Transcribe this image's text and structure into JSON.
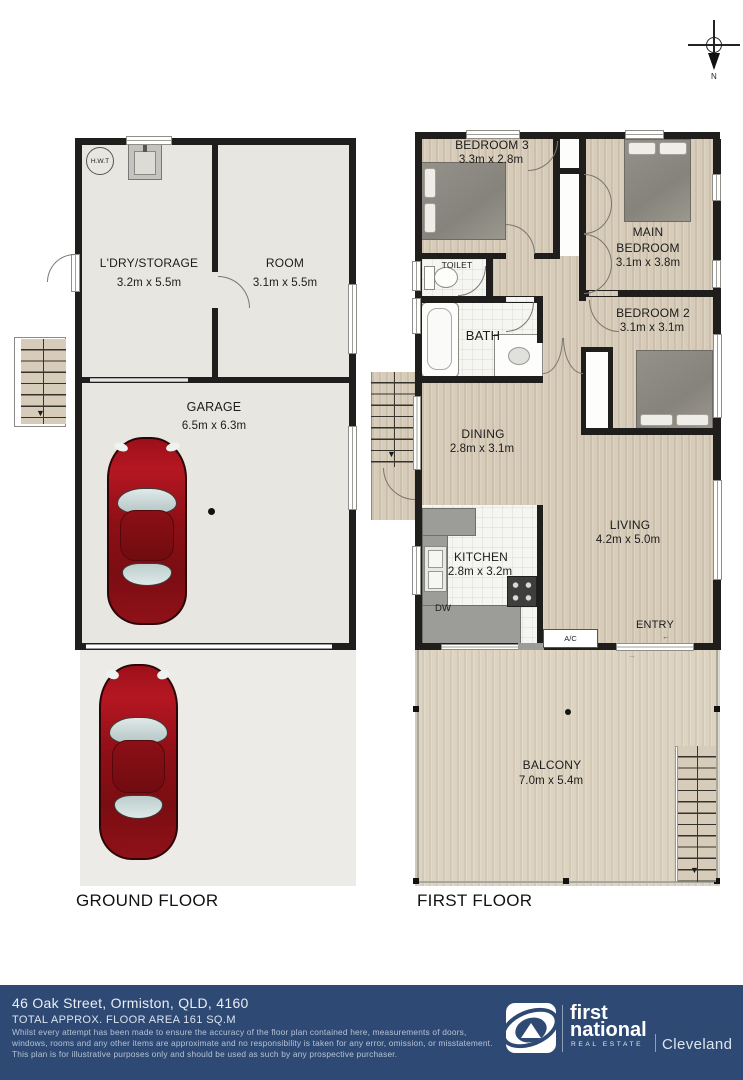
{
  "compass": {
    "north_label": "N"
  },
  "ground_floor": {
    "title": "GROUND FLOOR",
    "hwt_label": "H.W.T",
    "rooms": {
      "laundry": {
        "name": "L'DRY/STORAGE",
        "dims": "3.2m x 5.5m"
      },
      "room": {
        "name": "ROOM",
        "dims": "3.1m x 5.5m"
      },
      "garage": {
        "name": "GARAGE",
        "dims": "6.5m x 6.3m"
      }
    }
  },
  "first_floor": {
    "title": "FIRST FLOOR",
    "rooms": {
      "bedroom3": {
        "name": "BEDROOM 3",
        "dims": "3.3m x 2.8m"
      },
      "main_bedroom": {
        "name": "MAIN BEDROOM",
        "dims": "3.1m x 3.8m"
      },
      "bedroom2": {
        "name": "BEDROOM 2",
        "dims": "3.1m x 3.1m"
      },
      "toilet": {
        "name": "TOILET"
      },
      "bath": {
        "name": "BATH"
      },
      "dining": {
        "name": "DINING",
        "dims": "2.8m x 3.1m"
      },
      "kitchen": {
        "name": "KITCHEN",
        "dims": "2.8m x 3.2m"
      },
      "living": {
        "name": "LIVING",
        "dims": "4.2m x 5.0m"
      },
      "entry": {
        "name": "ENTRY"
      },
      "balcony": {
        "name": "BALCONY",
        "dims": "7.0m x 5.4m"
      }
    },
    "labels": {
      "dishwasher": "DW",
      "air_conditioner": "A/C"
    }
  },
  "icons": {
    "stairs_down_arrow": "▼",
    "entry_arrow_left": "←",
    "entry_arrow_right": "→"
  },
  "footer": {
    "address": "46 Oak Street, Ormiston, QLD, 4160",
    "floor_area": "TOTAL APPROX. FLOOR AREA 161 SQ.M",
    "disclaimer_lines": [
      "Whilst every attempt has been made to ensure the accuracy of the floor plan contained here, measurements of doors,",
      "windows, rooms and any other items are approximate and no responsibility is taken for any error, omission, or misstatement.",
      "This plan is for illustrative purposes only and should be used as such by any prospective purchaser."
    ],
    "brand": {
      "name_line1": "first",
      "name_line2": "national",
      "tagline": "REAL ESTATE",
      "office": "Cleveland"
    }
  },
  "colors": {
    "footer_navy": "#2e4a74",
    "wall": "#201e1c",
    "wood_floor": "#d7ccb9",
    "concrete_floor": "#e7e6e1",
    "car_red": "#a3121b"
  }
}
